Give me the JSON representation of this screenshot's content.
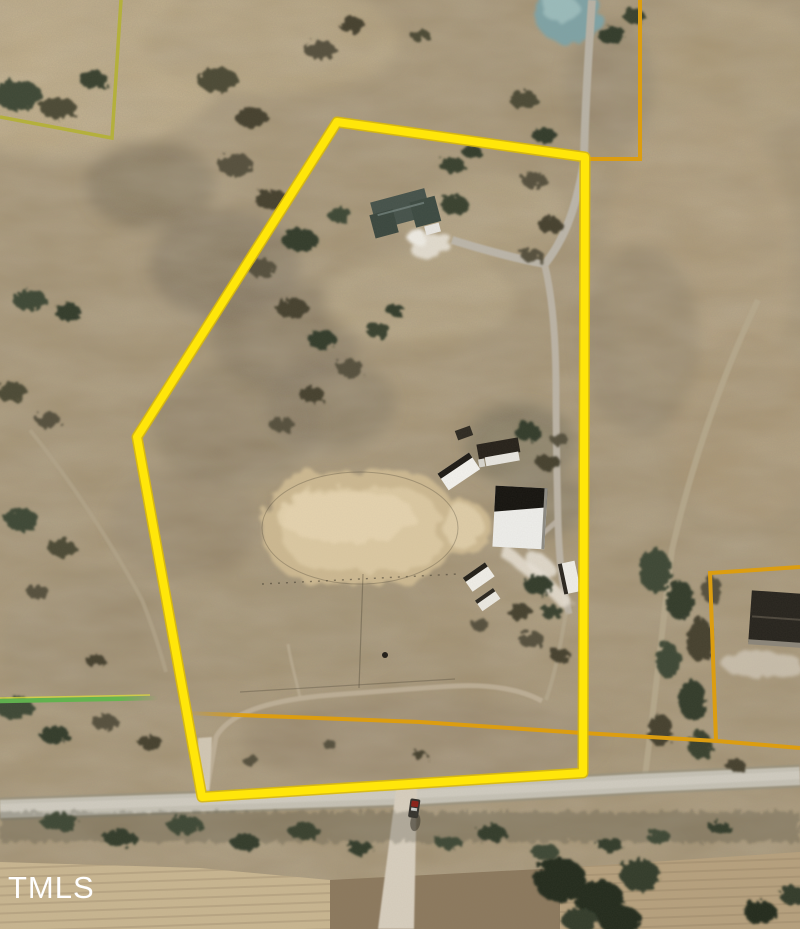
{
  "watermark": {
    "text": "TMLS",
    "color": "#ffffff"
  },
  "map": {
    "kind": "aerial-parcel-map",
    "features": [
      "subject-parcel-boundary",
      "main-house",
      "house-driveway",
      "riding-arena",
      "round-pen",
      "barn",
      "run-in-sheds",
      "farm-track",
      "pond",
      "public-road",
      "vehicle-on-road",
      "neighbor-house",
      "plowed-fields",
      "tree-lines"
    ]
  },
  "overlays": {
    "subject_parcel": {
      "points": "337,122 585,157 583,773 202,797 137,437",
      "color": "#ffe60a",
      "edge_color": "#d9b90a"
    },
    "ne_adjacent_parcel": {
      "points": "640,0 640,159 589,159",
      "color": "#dc9d10"
    },
    "east_adjacent_parcel": {
      "points": "800,567 710,573 716,741",
      "color": "#dc9d10"
    },
    "south_adjacent_line": {
      "points": "185,713 420,722 583,733 717,741 800,748",
      "color": "#dc9d10"
    },
    "nw_adjacent_parcel": {
      "points": "121,0 112,138 0,117",
      "color": "#b3b038"
    },
    "west_adjacent_line": {
      "points": "0,701 158,698",
      "color": "#5fae4e"
    }
  },
  "terrain": {
    "base": "#a3906f",
    "pale_field": "#c9b691",
    "dark_field": "#8c795e",
    "road": "#c6c2b6",
    "sand_arena": "#dcc9a3",
    "pond": "#7fa3a6"
  }
}
